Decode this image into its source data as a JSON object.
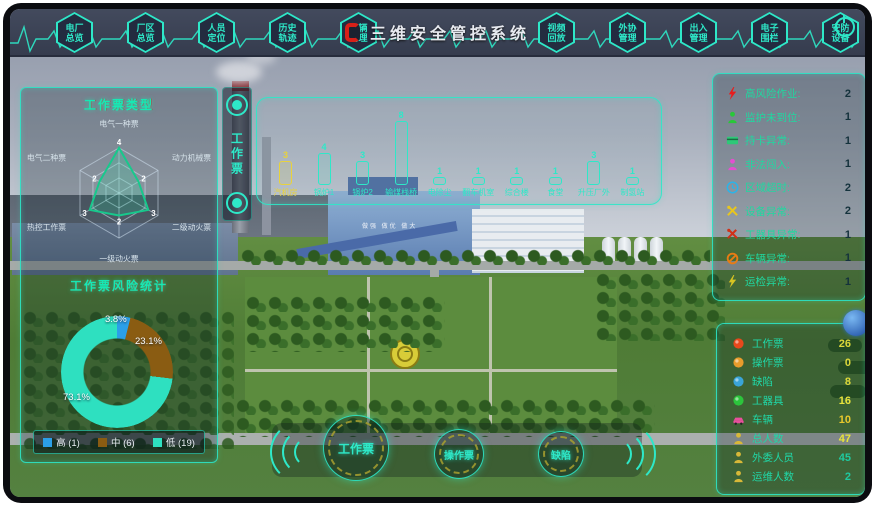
{
  "title": "三维安全管控系统",
  "topbar": {
    "nav_left": [
      {
        "line1": "电厂",
        "line2": "总览"
      },
      {
        "line1": "厂区",
        "line2": "总览"
      },
      {
        "line1": "人员",
        "line2": "定位"
      },
      {
        "line1": "历史",
        "line2": "轨迹"
      },
      {
        "line1": "车辆",
        "line2": "管理"
      }
    ],
    "nav_right": [
      {
        "line1": "视频",
        "line2": "回放"
      },
      {
        "line1": "外协",
        "line2": "管理"
      },
      {
        "line1": "出入",
        "line2": "管理"
      },
      {
        "line1": "电子",
        "line2": "围栏"
      },
      {
        "line1": "安防",
        "line2": "设备"
      }
    ]
  },
  "left_panel": {
    "radar": {
      "title": "工作票类型",
      "type": "radar",
      "categories": [
        "电气一种票",
        "动力机械票",
        "二级动火票",
        "一级动火票",
        "热控工作票",
        "电气二种票"
      ],
      "values": [
        4,
        2,
        3,
        2,
        3,
        2
      ],
      "max": 4
    },
    "donut": {
      "title": "工作票风险统计",
      "type": "pie",
      "segments": [
        {
          "label": "高",
          "count": 1,
          "percent": "3.8%",
          "legend_label": "高 (1)",
          "color": "#2b9fe8"
        },
        {
          "label": "中",
          "count": 6,
          "percent": "23.1%",
          "legend_label": "中 (6)",
          "color": "#8a5c12"
        },
        {
          "label": "低",
          "count": 19,
          "percent": "73.1%",
          "legend_label": "低 (19)",
          "color": "#2ee0c0"
        }
      ]
    }
  },
  "work_ticket_tab": {
    "label": "工作票"
  },
  "area_chart": {
    "type": "bar",
    "items": [
      {
        "label": "汽机房",
        "value": 3,
        "highlight": true
      },
      {
        "label": "锅炉1",
        "value": 4,
        "highlight": false
      },
      {
        "label": "锅炉2",
        "value": 3,
        "highlight": false
      },
      {
        "label": "输煤栈桥",
        "value": 8,
        "highlight": false
      },
      {
        "label": "电除尘",
        "value": 1,
        "highlight": false
      },
      {
        "label": "翻车机室",
        "value": 1,
        "highlight": false
      },
      {
        "label": "综合楼",
        "value": 1,
        "highlight": false
      },
      {
        "label": "食堂",
        "value": 1,
        "highlight": false
      },
      {
        "label": "升压厂外",
        "value": 3,
        "highlight": false
      },
      {
        "label": "制氢站",
        "value": 1,
        "highlight": false
      }
    ]
  },
  "alarm_panel": {
    "rows": [
      {
        "icon": "bolt",
        "color": "#e81c1c",
        "label": "高风险作业:",
        "count": 2
      },
      {
        "icon": "person",
        "color": "#28c838",
        "label": "监护未到位:",
        "count": 1
      },
      {
        "icon": "card",
        "color": "#2ec878",
        "label": "持卡异常:",
        "count": 1
      },
      {
        "icon": "person",
        "color": "#e44fd0",
        "label": "非法闯入:",
        "count": 1
      },
      {
        "icon": "clock",
        "color": "#2bb4e8",
        "label": "区域超时:",
        "count": 2
      },
      {
        "icon": "tools",
        "color": "#e8c61e",
        "label": "设备异常:",
        "count": 2
      },
      {
        "icon": "tools",
        "color": "#d03018",
        "label": "工器具异常:",
        "count": 1
      },
      {
        "icon": "ban",
        "color": "#e87c14",
        "label": "车辆异常:",
        "count": 1
      },
      {
        "icon": "bolt",
        "color": "#d8c422",
        "label": "运检异常:",
        "count": 1
      }
    ]
  },
  "stats_panel": {
    "rows": [
      {
        "icon": "dot",
        "color": "#e8481c",
        "label": "工作票",
        "count": 26,
        "count_color": "#dcd83a"
      },
      {
        "icon": "dot",
        "color": "#e89c2c",
        "label": "操作票",
        "count": 0,
        "count_color": "#dcd83a"
      },
      {
        "icon": "dot",
        "color": "#3aa4d8",
        "label": "缺陷",
        "count": 8,
        "count_color": "#dcd83a"
      },
      {
        "icon": "dot",
        "color": "#2cc43c",
        "label": "工器具",
        "count": 16,
        "count_color": "#e8e43c"
      },
      {
        "icon": "car",
        "color": "#e8509c",
        "label": "车辆",
        "count": 10,
        "count_color": "#e8c82c"
      },
      {
        "icon": "person",
        "color": "#d8b838",
        "label": "总人数",
        "count": 47,
        "count_color": "#e8e43c"
      },
      {
        "icon": "person",
        "color": "#d8b838",
        "label": "外委人员",
        "count": 45,
        "count_color": "#1fc9a0"
      },
      {
        "icon": "person",
        "color": "#d8b838",
        "label": "运维人数",
        "count": 2,
        "count_color": "#1fc9a0"
      }
    ]
  },
  "bottom_buttons": [
    {
      "label": "工作票"
    },
    {
      "label": "操作票"
    },
    {
      "label": "缺陷"
    }
  ],
  "scene": {
    "building_slogan": "做强 做优 做大"
  },
  "accent_color": "#2ee8c8"
}
